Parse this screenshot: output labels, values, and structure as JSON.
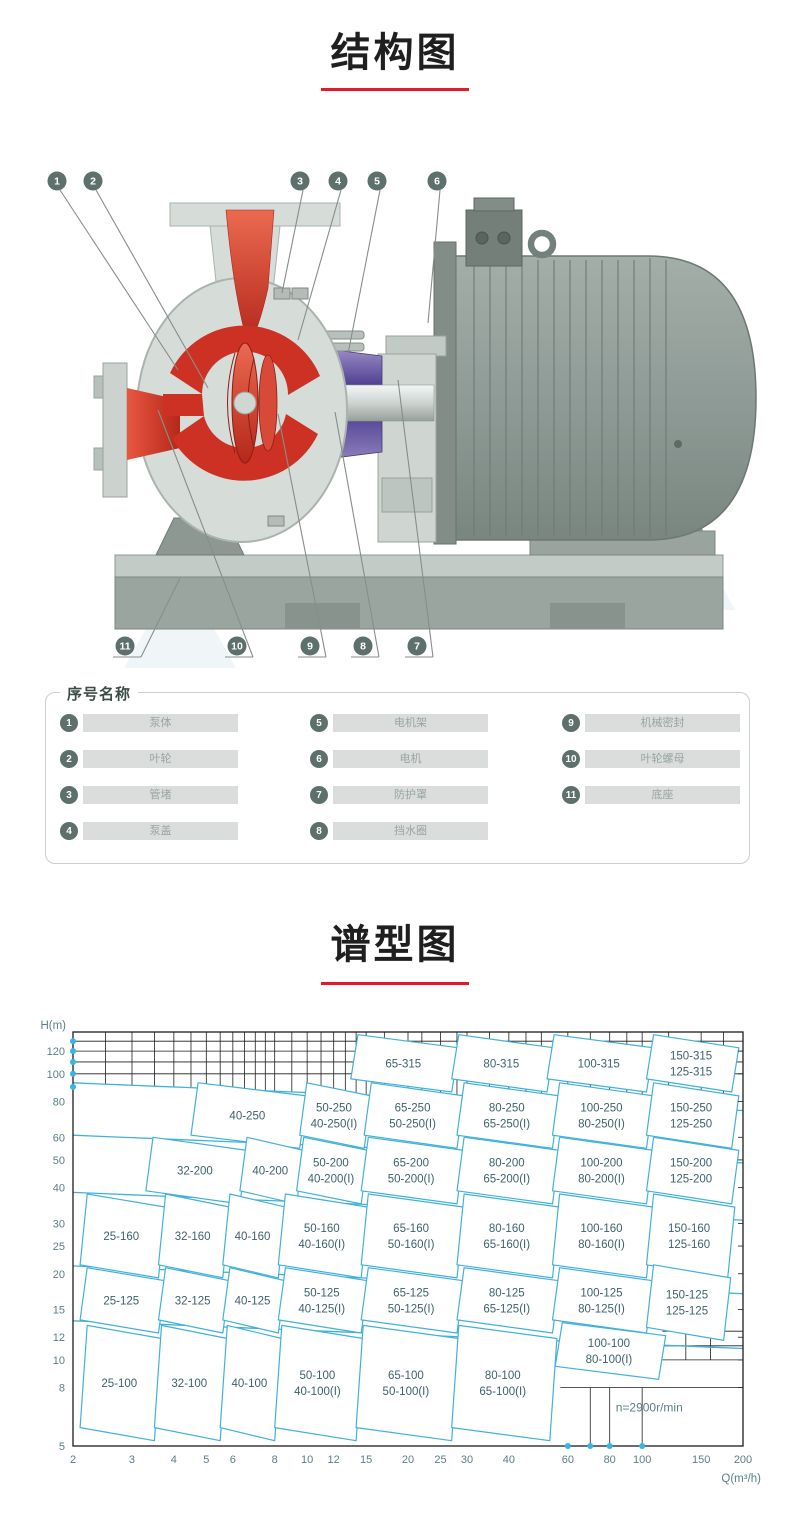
{
  "page": {
    "accent_red": "#e6182b"
  },
  "sections": {
    "structure": {
      "title": "结构图"
    },
    "spectrum": {
      "title": "谱型图"
    }
  },
  "structure_diagram": {
    "callouts_top": [
      "1",
      "2",
      "3",
      "4",
      "5",
      "6"
    ],
    "callouts_bottom": [
      "11",
      "10",
      "9",
      "8",
      "7"
    ],
    "colors": {
      "red_flow": "#cc3124",
      "casing_gray": "#d6dcd8",
      "bracket_purple": "#6f5fa6",
      "motor_gray": "#94a09b",
      "base_gray": "#9aa5a0"
    }
  },
  "legend": {
    "title": "序号名称",
    "items": [
      {
        "num": "1",
        "name": "泵体"
      },
      {
        "num": "2",
        "name": "叶轮"
      },
      {
        "num": "3",
        "name": "管堵"
      },
      {
        "num": "4",
        "name": "泵盖"
      },
      {
        "num": "5",
        "name": "电机架"
      },
      {
        "num": "6",
        "name": "电机"
      },
      {
        "num": "7",
        "name": "防护罩"
      },
      {
        "num": "8",
        "name": "挡水圈"
      },
      {
        "num": "9",
        "name": "机械密封"
      },
      {
        "num": "10",
        "name": "叶轮螺母"
      },
      {
        "num": "11",
        "name": "底座"
      }
    ]
  },
  "chart_data": {
    "type": "region-map",
    "title": "谱型图",
    "x_axis": {
      "label": "Q(m³/h)",
      "scale": "log",
      "range": [
        2,
        200
      ],
      "ticks": [
        2,
        3,
        4,
        5,
        6,
        8,
        10,
        12,
        15,
        20,
        25,
        30,
        40,
        60,
        80,
        100,
        150,
        200
      ]
    },
    "y_axis": {
      "label": "H(m)",
      "scale": "log",
      "range": [
        5,
        140
      ],
      "ticks": [
        120,
        100,
        80,
        60,
        50,
        40,
        30,
        25,
        20,
        15,
        12,
        10,
        8,
        5
      ]
    },
    "annotation": "n=2900r/min",
    "accent_blue": "#41b1da",
    "label_color": "#3e616b",
    "axis_dots": {
      "x_q": [
        60,
        70,
        80,
        100
      ],
      "y_h": [
        90,
        100,
        110,
        120,
        130
      ]
    },
    "row_boundaries_h": [
      93,
      61,
      38.5,
      21.3,
      13.7
    ],
    "regions": [
      {
        "labels": [
          "65-315"
        ],
        "q_range": [
          13.5,
          27
        ],
        "h_range": [
          96,
          137
        ]
      },
      {
        "labels": [
          "80-315"
        ],
        "q_range": [
          27,
          52
        ],
        "h_range": [
          96,
          137
        ]
      },
      {
        "labels": [
          "100-315"
        ],
        "q_range": [
          52,
          103
        ],
        "h_range": [
          96,
          137
        ]
      },
      {
        "labels": [
          "150-315",
          "125-315"
        ],
        "q_range": [
          103,
          185
        ],
        "h_range": [
          96,
          137
        ]
      },
      {
        "labels": [
          "40-250"
        ],
        "q_range": [
          4.5,
          9.5
        ],
        "h_range": [
          61,
          93
        ]
      },
      {
        "labels": [
          "50-250",
          "40-250(I)"
        ],
        "q_range": [
          9.5,
          14.8
        ],
        "h_range": [
          61,
          93
        ]
      },
      {
        "labels": [
          "65-250",
          "50-250(I)"
        ],
        "q_range": [
          14.8,
          28
        ],
        "h_range": [
          61,
          93
        ]
      },
      {
        "labels": [
          "80-250",
          "65-250(I)"
        ],
        "q_range": [
          28,
          54
        ],
        "h_range": [
          61,
          93
        ]
      },
      {
        "labels": [
          "100-250",
          "80-250(I)"
        ],
        "q_range": [
          54,
          103
        ],
        "h_range": [
          61,
          93
        ]
      },
      {
        "labels": [
          "150-250",
          "125-250"
        ],
        "q_range": [
          103,
          185
        ],
        "h_range": [
          61,
          93
        ]
      },
      {
        "labels": [
          "32-200"
        ],
        "q_range": [
          3.3,
          6.3
        ],
        "h_range": [
          39,
          60
        ]
      },
      {
        "labels": [
          "40-200"
        ],
        "q_range": [
          6.3,
          9.3
        ],
        "h_range": [
          39,
          60
        ]
      },
      {
        "labels": [
          "50-200",
          "40-200(I)"
        ],
        "q_range": [
          9.3,
          14.5
        ],
        "h_range": [
          39,
          60
        ]
      },
      {
        "labels": [
          "65-200",
          "50-200(I)"
        ],
        "q_range": [
          14.5,
          28
        ],
        "h_range": [
          39,
          60
        ]
      },
      {
        "labels": [
          "80-200",
          "65-200(I)"
        ],
        "q_range": [
          28,
          54
        ],
        "h_range": [
          39,
          60
        ]
      },
      {
        "labels": [
          "100-200",
          "80-200(I)"
        ],
        "q_range": [
          54,
          103
        ],
        "h_range": [
          39,
          60
        ]
      },
      {
        "labels": [
          "150-200",
          "125-200"
        ],
        "q_range": [
          103,
          185
        ],
        "h_range": [
          39,
          60
        ]
      },
      {
        "labels": [
          "25-160"
        ],
        "q_range": [
          2.1,
          3.6
        ],
        "h_range": [
          21.5,
          38
        ]
      },
      {
        "labels": [
          "32-160"
        ],
        "q_range": [
          3.6,
          5.6
        ],
        "h_range": [
          21.5,
          38
        ]
      },
      {
        "labels": [
          "40-160"
        ],
        "q_range": [
          5.6,
          8.2
        ],
        "h_range": [
          21.5,
          38
        ]
      },
      {
        "labels": [
          "50-160",
          "40-160(I)"
        ],
        "q_range": [
          8.2,
          14.5
        ],
        "h_range": [
          21.5,
          38
        ]
      },
      {
        "labels": [
          "65-160",
          "50-160(I)"
        ],
        "q_range": [
          14.5,
          28
        ],
        "h_range": [
          21.5,
          38
        ]
      },
      {
        "labels": [
          "80-160",
          "65-160(I)"
        ],
        "q_range": [
          28,
          54
        ],
        "h_range": [
          21.5,
          38
        ]
      },
      {
        "labels": [
          "100-160",
          "80-160(I)"
        ],
        "q_range": [
          54,
          103
        ],
        "h_range": [
          21.5,
          38
        ]
      },
      {
        "labels": [
          "150-160",
          "125-160"
        ],
        "q_range": [
          103,
          180
        ],
        "h_range": [
          21.5,
          38
        ]
      },
      {
        "labels": [
          "25-125"
        ],
        "q_range": [
          2.1,
          3.6
        ],
        "h_range": [
          13.8,
          21
        ]
      },
      {
        "labels": [
          "32-125"
        ],
        "q_range": [
          3.6,
          5.6
        ],
        "h_range": [
          13.8,
          21
        ]
      },
      {
        "labels": [
          "40-125"
        ],
        "q_range": [
          5.6,
          8.2
        ],
        "h_range": [
          13.8,
          21
        ]
      },
      {
        "labels": [
          "50-125",
          "40-125(I)"
        ],
        "q_range": [
          8.2,
          14.5
        ],
        "h_range": [
          13.8,
          21
        ]
      },
      {
        "labels": [
          "65-125",
          "50-125(I)"
        ],
        "q_range": [
          14.5,
          28
        ],
        "h_range": [
          13.8,
          21
        ]
      },
      {
        "labels": [
          "80-125",
          "65-125(I)"
        ],
        "q_range": [
          28,
          54
        ],
        "h_range": [
          13.8,
          21
        ]
      },
      {
        "labels": [
          "100-125",
          "80-125(I)"
        ],
        "q_range": [
          54,
          103
        ],
        "h_range": [
          13.8,
          21
        ]
      },
      {
        "labels": [
          "150-125",
          "125-125"
        ],
        "q_range": [
          103,
          175
        ],
        "h_range": [
          13,
          21.5
        ]
      },
      {
        "labels": [
          "25-100"
        ],
        "q_range": [
          2.1,
          3.5
        ],
        "h_range": [
          5.8,
          13.2
        ]
      },
      {
        "labels": [
          "32-100"
        ],
        "q_range": [
          3.5,
          5.5
        ],
        "h_range": [
          5.8,
          13.2
        ]
      },
      {
        "labels": [
          "40-100"
        ],
        "q_range": [
          5.5,
          8
        ],
        "h_range": [
          5.8,
          13.2
        ]
      },
      {
        "labels": [
          "50-100",
          "40-100(I)"
        ],
        "q_range": [
          8,
          14
        ],
        "h_range": [
          5.8,
          13.2
        ]
      },
      {
        "labels": [
          "65-100",
          "50-100(I)"
        ],
        "q_range": [
          14,
          27
        ],
        "h_range": [
          5.8,
          13.2
        ]
      },
      {
        "labels": [
          "80-100",
          "65-100(I)"
        ],
        "q_range": [
          27,
          53
        ],
        "h_range": [
          5.8,
          13.2
        ]
      },
      {
        "labels": [
          "100-100",
          "80-100(I)"
        ],
        "q_range": [
          55,
          112
        ],
        "h_range": [
          9.5,
          13.5
        ]
      }
    ]
  }
}
